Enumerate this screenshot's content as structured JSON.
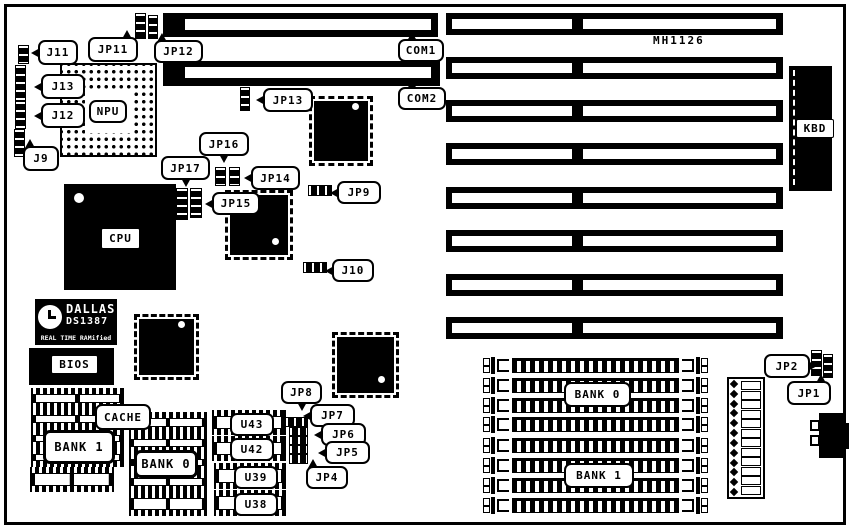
{
  "board": {
    "model": "MH1126"
  },
  "diagram": {
    "colors": {
      "ink": "#000000",
      "paper": "#ffffff"
    }
  },
  "callouts": {
    "j9": "J9",
    "j10": "J10",
    "j11": "J11",
    "j12": "J12",
    "j13": "J13",
    "jp1": "JP1",
    "jp2": "JP2",
    "jp4": "JP4",
    "jp5": "JP5",
    "jp6": "JP6",
    "jp7": "JP7",
    "jp8": "JP8",
    "jp9": "JP9",
    "jp11": "JP11",
    "jp12": "JP12",
    "jp13": "JP13",
    "jp14": "JP14",
    "jp15": "JP15",
    "jp16": "JP16",
    "jp17": "JP17",
    "com1": "COM1",
    "com2": "COM2"
  },
  "chips": {
    "npu": "NPU",
    "cpu": "CPU",
    "bios": "BIOS",
    "kbd": "KBD",
    "cache": "CACHE",
    "bank0_dip": "BANK 0",
    "bank1_dip": "BANK 1",
    "bank0_simm": "BANK 0",
    "bank1_simm": "BANK 1",
    "u38": "U38",
    "u39": "U39",
    "u42": "U42",
    "u43": "U43"
  },
  "rtc": {
    "brand": "DALLAS",
    "part": "DS1387",
    "line3": "REAL TIME RAMified"
  }
}
